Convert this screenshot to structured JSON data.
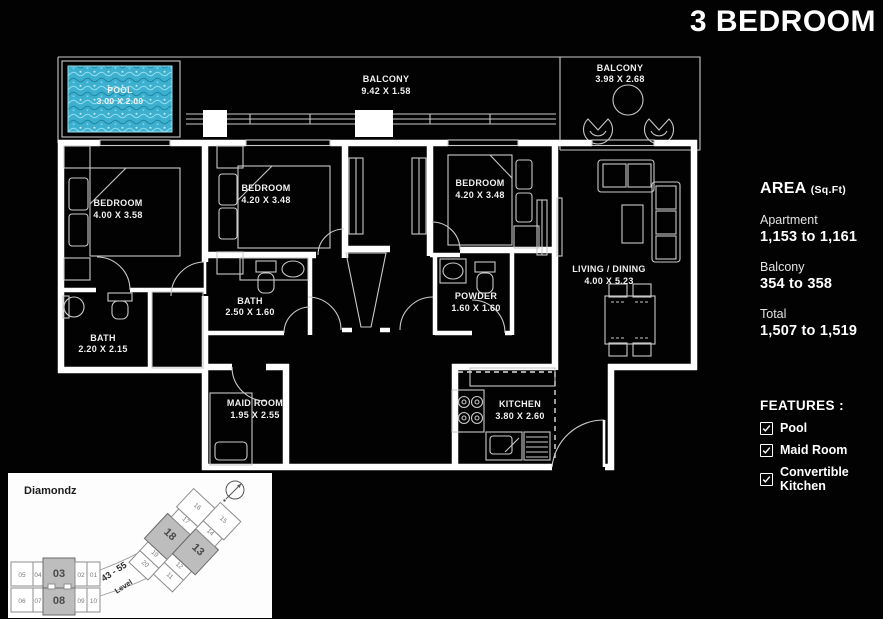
{
  "title": "3 BEDROOM",
  "area_panel": {
    "heading": "AREA",
    "heading_unit": "(Sq.Ft)",
    "rows": [
      {
        "label": "Apartment",
        "value": "1,153 to 1,161"
      },
      {
        "label": "Balcony",
        "value": "354 to 358"
      },
      {
        "label": "Total",
        "value": "1,507 to 1,519"
      }
    ]
  },
  "features_panel": {
    "heading": "FEATURES :",
    "items": [
      {
        "label": "Pool",
        "checked": true
      },
      {
        "label": "Maid Room",
        "checked": true
      },
      {
        "label": "Convertible Kitchen",
        "checked": true
      }
    ]
  },
  "floor_plan": {
    "rooms": [
      {
        "name": "POOL",
        "dims": "3.00 X 2.00"
      },
      {
        "name": "BALCONY",
        "dims": "9.42 X 1.58"
      },
      {
        "name": "BALCONY",
        "dims": "3.98 X 2.68"
      },
      {
        "name": "BEDROOM",
        "dims": "4.00 X 3.58"
      },
      {
        "name": "BEDROOM",
        "dims": "4.20 X 3.48"
      },
      {
        "name": "BEDROOM",
        "dims": "4.20 X 3.48"
      },
      {
        "name": "LIVING / DINING",
        "dims": "4.00 X 5.23"
      },
      {
        "name": "BATH",
        "dims": "2.50 X 1.60"
      },
      {
        "name": "POWDER",
        "dims": "1.60 X 1.60"
      },
      {
        "name": "BATH",
        "dims": "2.20 X 2.15"
      },
      {
        "name": "MAID ROOM",
        "dims": "1.95 X 2.55"
      },
      {
        "name": "KITCHEN",
        "dims": "3.80 X 2.60"
      }
    ]
  },
  "key_plan": {
    "building_name": "Diamondz",
    "level_range": "43 - 55",
    "level_label": "Level",
    "highlighted_units": [
      "03",
      "08",
      "13",
      "18"
    ],
    "units_row_top": [
      "05",
      "04",
      "03",
      "02",
      "01"
    ],
    "units_row_bottom": [
      "06",
      "07",
      "08",
      "09",
      "10"
    ],
    "units_wing_upper": [
      "20",
      "19",
      "18",
      "17",
      "16"
    ],
    "units_wing_lower": [
      "11",
      "12",
      "13",
      "14",
      "15"
    ]
  },
  "colors": {
    "background": "#000000",
    "plan_line": "#ffffff",
    "pool_water": "#3eb0cf",
    "keyplan_highlight": "#bdbdbd"
  }
}
